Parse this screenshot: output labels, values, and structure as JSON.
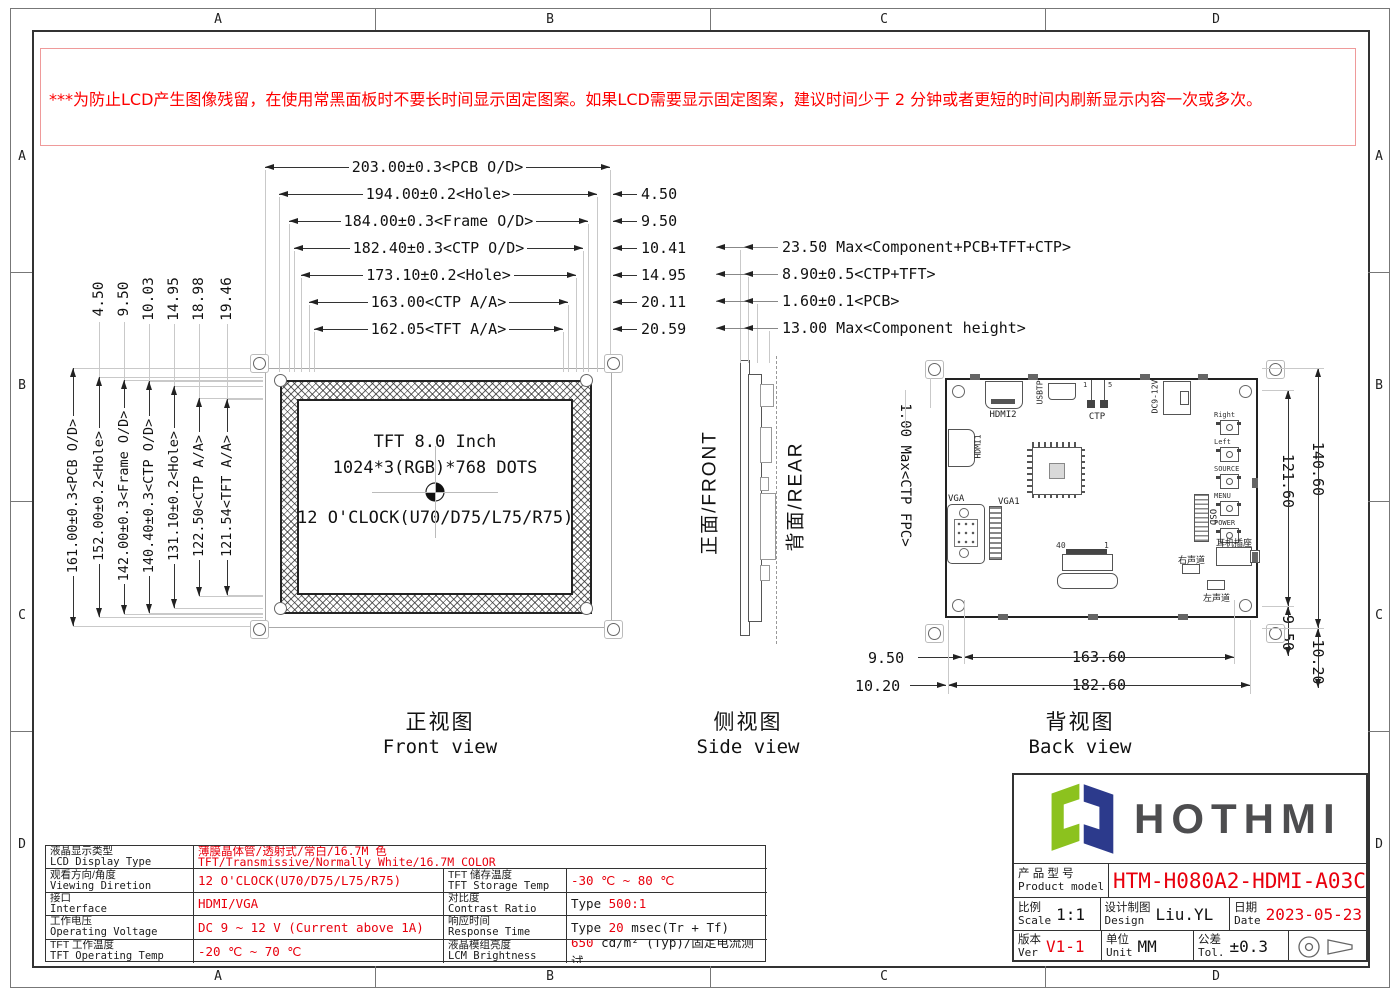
{
  "colors": {
    "accent_red": "#e8000d",
    "logo_green": "#8cc21e",
    "logo_navy": "#2c3a8c",
    "logo_text": "#4d4d4f"
  },
  "sheet": {
    "grid_cols": [
      "A",
      "B",
      "C",
      "D"
    ],
    "grid_rows": [
      "A",
      "B",
      "C",
      "D"
    ]
  },
  "warning": {
    "lines": [
      "***为防止LCD产生图像残留，在使用常黑面板时不要长时间显示固定图案。如果LCD需要显示固定图案，建议时间少于 2 分钟或者更短的时间内刷新显示内容一次或多次。",
      "***In order to prevent the LCD from producing image retention, do not display a fixed pattern for a long time when using a normally black panel.If the",
      " LCD needs to display a fixed pattern,  it is recommended to refresh the display one or more times in less than 2 minutes or less.",
      "强烈建议使用黑色图像或移动图像作为屏幕保护程序。It is strongly recommended to use a black image or moving image as a screen saver."
    ]
  },
  "front_view": {
    "title_cn": "正视图",
    "title_en": "Front view",
    "panel_line1": "TFT 8.0 Inch",
    "panel_line2": "1024*3(RGB)*768 DOTS",
    "panel_line3": "12 O'CLOCK(U70/D75/L75/R75)",
    "top_dims": [
      "203.00±0.3<PCB O/D>",
      "194.00±0.2<Hole>",
      "184.00±0.3<Frame O/D>",
      "182.40±0.3<CTP O/D>",
      "173.10±0.2<Hole>",
      "163.00<CTP A/A>",
      "162.05<TFT A/A>"
    ],
    "top_offsets": [
      "4.50",
      "9.50",
      "10.41",
      "14.95",
      "20.11",
      "20.59"
    ],
    "left_dims": [
      "161.00±0.3<PCB O/D>",
      "152.00±0.2<Hole>",
      "142.00±0.3<Frame O/D>",
      "140.40±0.3<CTP O/D>",
      "131.10±0.2<Hole>",
      "122.50<CTP A/A>",
      "121.54<TFT A/A>"
    ],
    "left_offsets": [
      "4.50",
      "9.50",
      "10.03",
      "14.95",
      "18.98",
      "19.46"
    ]
  },
  "side_view": {
    "title_cn": "侧视图",
    "title_en": "Side view",
    "front_label": "正面/FRONT",
    "rear_label": "背面/REAR",
    "dims": [
      "23.50 Max<Component+PCB+TFT+CTP>",
      "8.90±0.5<CTP+TFT>",
      "1.60±0.1<PCB>",
      "13.00 Max<Component height>"
    ]
  },
  "back_view": {
    "title_cn": "背视图",
    "title_en": "Back view",
    "labels": {
      "hdmi2": "HDMI2",
      "usbtp": "USBTP",
      "ctp": "CTP",
      "ctp_pin1": "1",
      "ctp_pin5": "5",
      "dc": "DC9-12V",
      "hdmi1": "HDMI1",
      "vga": "VGA",
      "vga1": "VGA1",
      "osd": "OSD",
      "headphone": "耳机插座",
      "right_ch": "右声道",
      "left_ch": "左声道",
      "fpc_pin40": "40",
      "fpc_pin1": "1",
      "buttons": [
        "Right",
        "Left",
        "SOURCE",
        "MENU",
        "POWER"
      ]
    },
    "dims": {
      "ctp_fpc": "1.00 Max<CTP FPC>",
      "height_inner": "121.60",
      "height_outer": "140.60",
      "right_edge": "9.50",
      "right_edge2": "10.20",
      "left_edge": "9.50",
      "left_edge2": "10.20",
      "width_inner": "163.60",
      "width_outer": "182.60"
    }
  },
  "spec": {
    "rows": [
      {
        "label_cn": "液晶显示类型",
        "label_en": "LCD Display Type",
        "value_line1": "薄膜晶体管/透射式/常白/16.7M 色",
        "value_line2": "TFT/Transmissive/Normally White/16.7M COLOR"
      },
      {
        "label_cn": "观看方向/角度",
        "label_en": "Viewing Diretion",
        "value": [
          {
            "t": "12 O'CLOCK(U70/D75/L75/R75)",
            "red": true
          }
        ],
        "label2_cn": "TFT 储存温度",
        "label2_en": "TFT Storage Temp",
        "value2": [
          {
            "t": "-30 ℃ ~ 80 ℃",
            "red": true
          }
        ]
      },
      {
        "label_cn": "接口",
        "label_en": "Interface",
        "value": [
          {
            "t": "HDMI/VGA",
            "red": true
          }
        ],
        "label2_cn": "对比度",
        "label2_en": "Contrast Ratio",
        "value2": [
          {
            "t": "Type ",
            "red": false
          },
          {
            "t": "500:1",
            "red": true
          }
        ]
      },
      {
        "label_cn": "工作电压",
        "label_en": "Operating Voltage",
        "value": [
          {
            "t": "DC 9 ~ 12 V (Current above 1A)",
            "red": true
          }
        ],
        "label2_cn": "响应时间",
        "label2_en": "Response Time",
        "value2": [
          {
            "t": "Type ",
            "red": false
          },
          {
            "t": "20",
            "red": true
          },
          {
            "t": " msec(Tr + Tf)",
            "red": false
          }
        ]
      },
      {
        "label_cn": "TFT 工作温度",
        "label_en": "TFT Operating Temp",
        "value": [
          {
            "t": "-20 ℃ ~ 70 ℃",
            "red": true
          }
        ],
        "label2_cn": "液晶模组亮度",
        "label2_en": "LCM Brightness",
        "value2": [
          {
            "t": "650",
            "red": true
          },
          {
            "t": " cd/m² (Typ)/固定电流测试",
            "red": false
          }
        ]
      }
    ]
  },
  "title_block": {
    "brand": "HOTHMI",
    "product_label_cn": "产 品 型 号",
    "product_label_en": "Product model",
    "product_model": "HTM-H080A2-HDMI-A03C",
    "scale_cn": "比例",
    "scale_en": "Scale",
    "scale_val": "1:1",
    "design_cn": "设计制图",
    "design_en": "Design",
    "design_val": "Liu.YL",
    "date_cn": "日期",
    "date_en": "Date",
    "date_val": "2023-05-23",
    "ver_cn": "版本",
    "ver_en": "Ver",
    "ver_val": "V1-1",
    "unit_cn": "单位",
    "unit_en": "Unit",
    "unit_val": "MM",
    "tol_cn": "公差",
    "tol_en": "Tol.",
    "tol_val": "±0.3"
  }
}
